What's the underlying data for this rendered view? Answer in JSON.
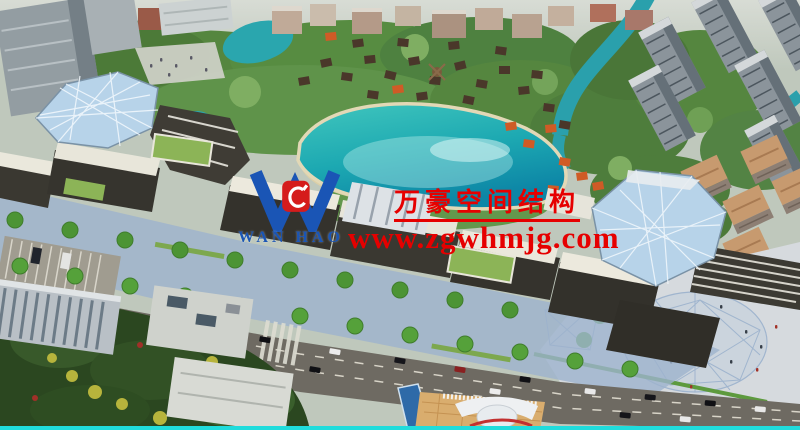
{
  "watermark": {
    "logo": {
      "text": "WAN HAO",
      "color": "#1a55b5",
      "emblem_color": "#d51c1c"
    },
    "company_name": "万豪空间结构",
    "website": "www.zgwhmjg.com",
    "text_color": "#e60000"
  },
  "scene": {
    "description": "Aerial architectural rendering: commercial street with two triangulated glass canopies, central turquoise lake ringed by cottage village with orange and brown roofs, residential apartment blocks upper right, tree-lined boulevard with cars, paved plaza with canopy shadow lower right",
    "colors": {
      "lake": "#2bb6b4",
      "lake_deep": "#0d86a6",
      "trees": "#55863f",
      "trees_dark": "#2b4720",
      "glass_canopy": "#b7d3e9",
      "road": "#6e6a62",
      "plaza": "#d6dade",
      "roof_white": "#eceade",
      "roof_green": "#8cb457",
      "roof_orange": "#cf5b26",
      "building_dark": "#36342e",
      "accent_line": "#20dcdc"
    }
  }
}
